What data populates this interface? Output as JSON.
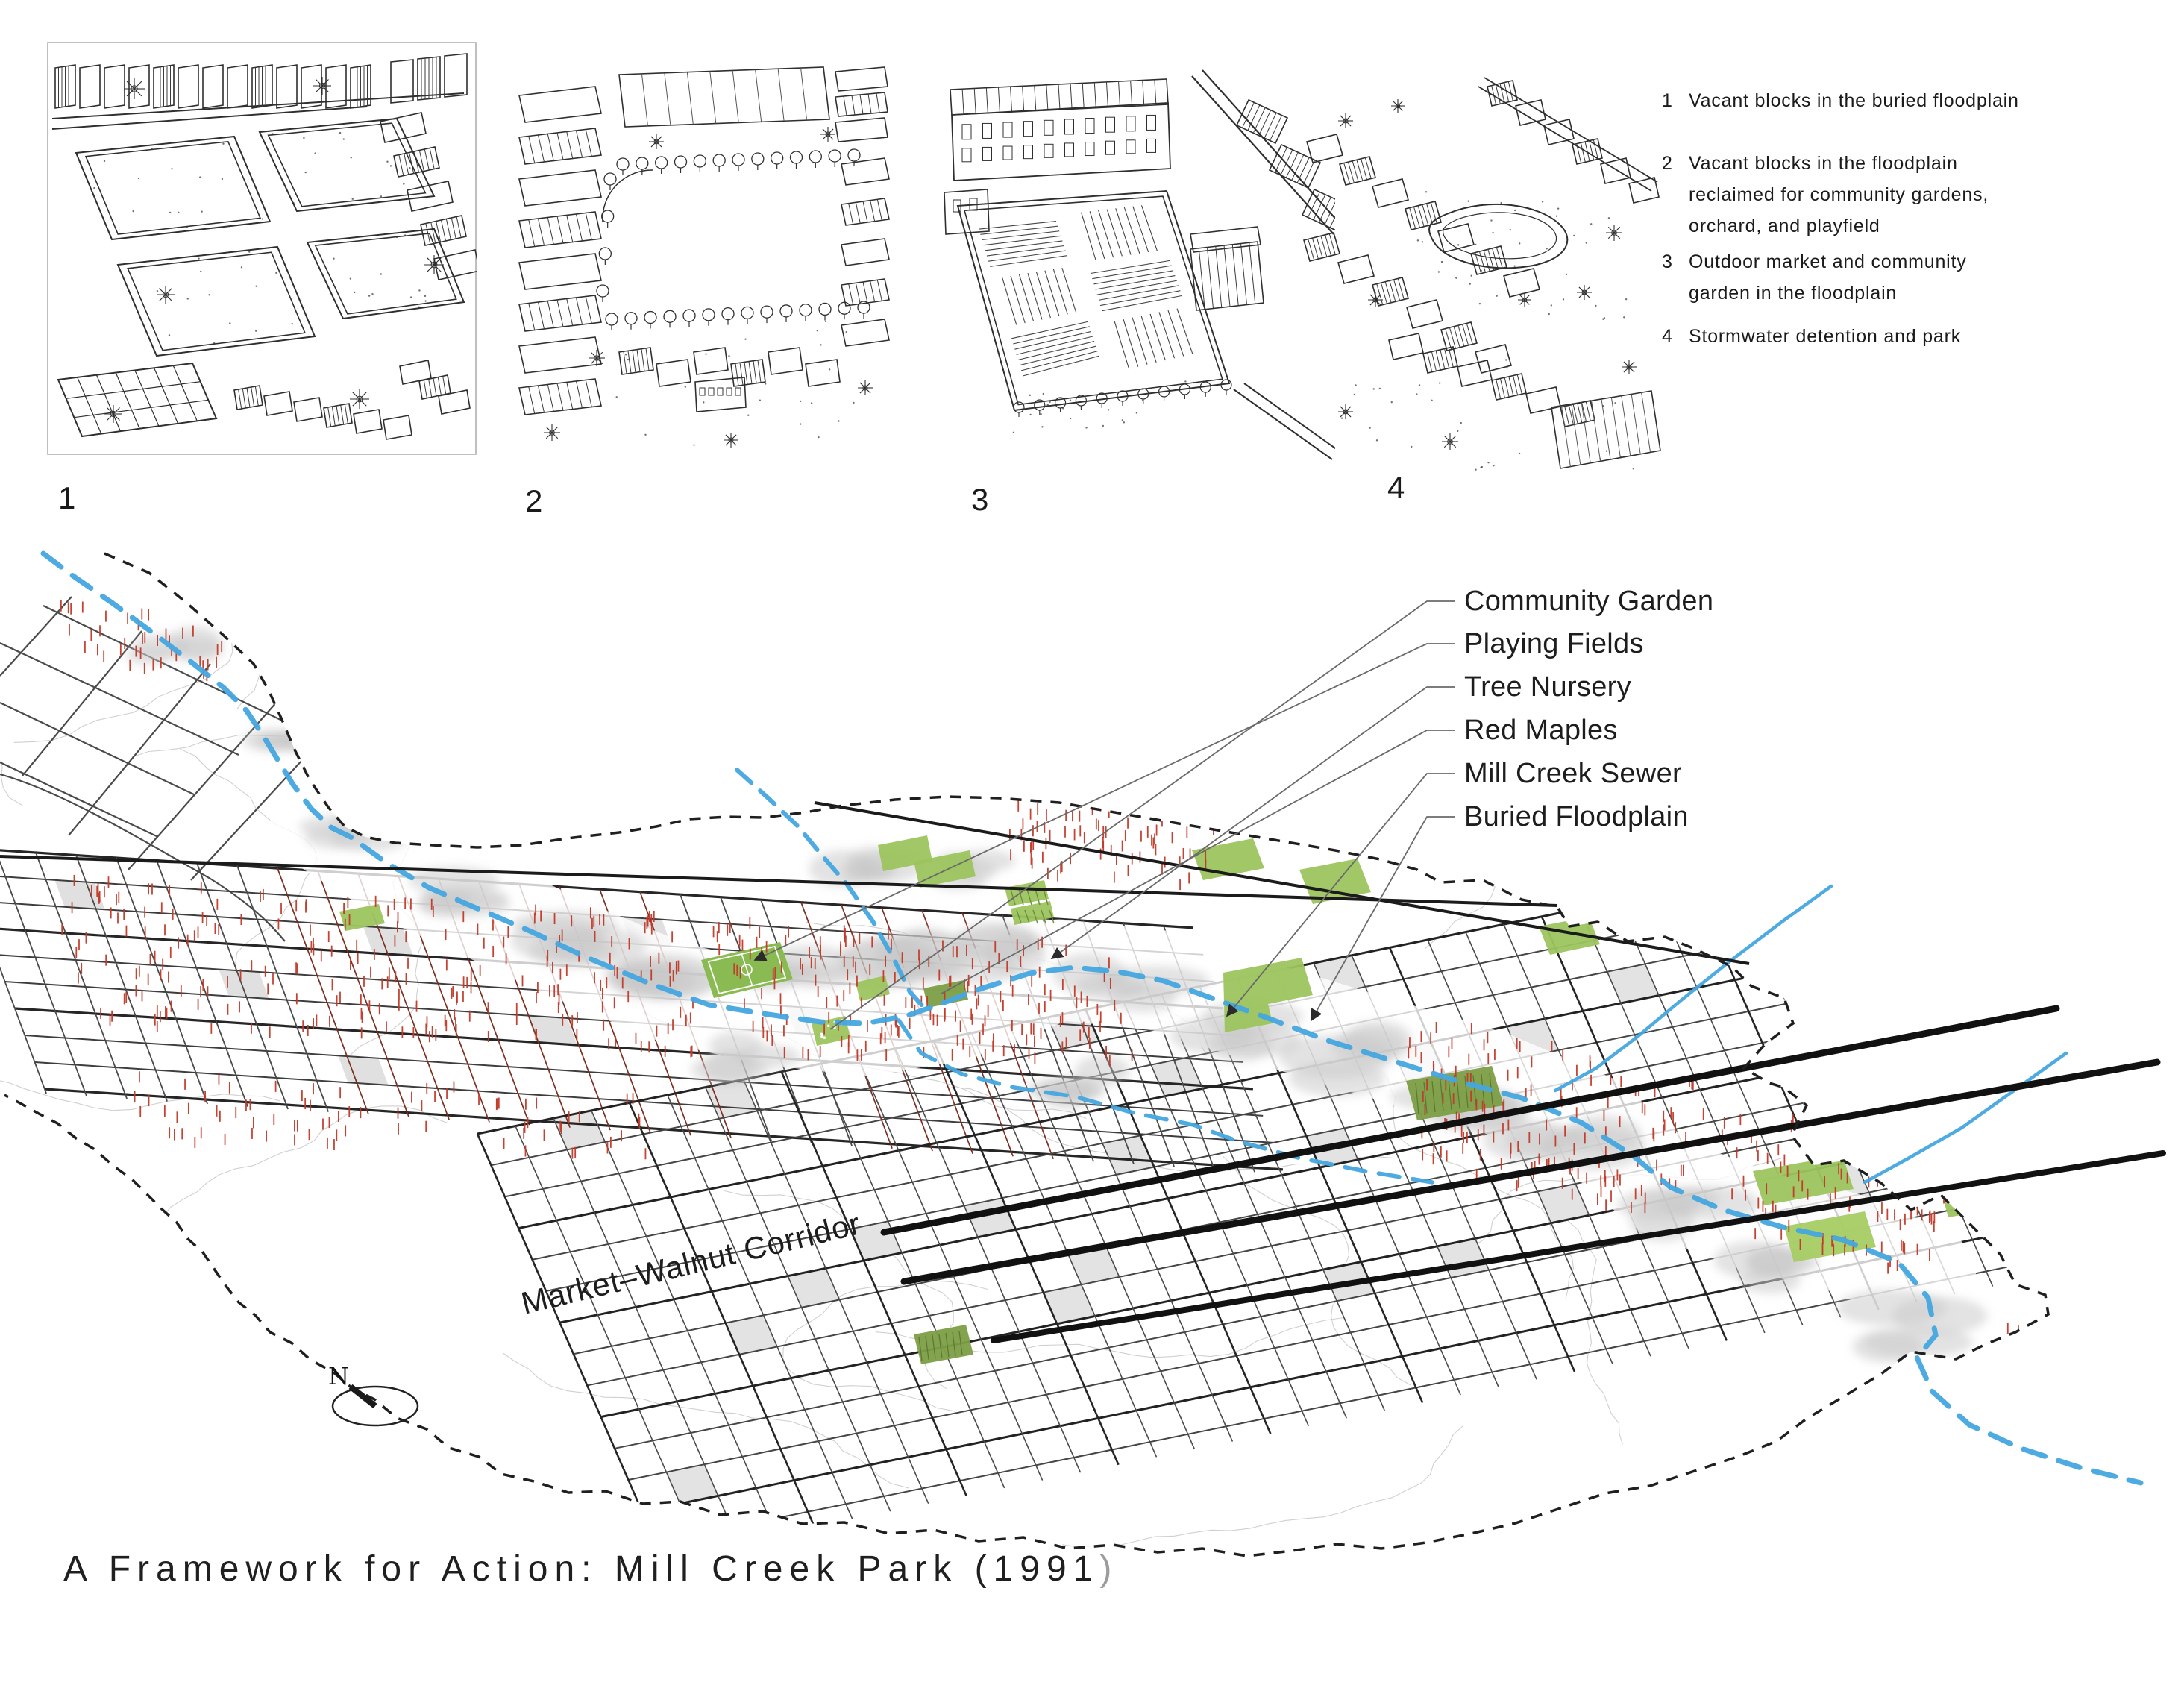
{
  "title": {
    "main": "A Framework for Action: Mill Creek Park (1991",
    "paren": ")"
  },
  "sketch_numbers": [
    "1",
    "2",
    "3",
    "4"
  ],
  "legend": {
    "items": [
      {
        "num": "1",
        "lines": [
          "Vacant blocks in the buried floodplain"
        ]
      },
      {
        "num": "2",
        "lines": [
          "Vacant blocks in the floodplain",
          "reclaimed for community gardens,",
          "orchard, and playfield"
        ]
      },
      {
        "num": "3",
        "lines": [
          "Outdoor market and community",
          "garden in the floodplain"
        ]
      },
      {
        "num": "4",
        "lines": [
          "Stormwater detention and park"
        ]
      }
    ]
  },
  "map": {
    "labels": [
      {
        "text": "Community Garden"
      },
      {
        "text": "Playing Fields"
      },
      {
        "text": "Tree Nursery"
      },
      {
        "text": "Red Maples"
      },
      {
        "text": "Mill Creek Sewer"
      },
      {
        "text": "Buried Floodplain"
      }
    ],
    "corridor_label": "Market–Walnut Corridor",
    "compass": "N",
    "colors": {
      "creek": "#45a7e0",
      "green": "#9cc45e",
      "green_dark": "#7d9e46",
      "field_green": "#8abb52",
      "red_tick": "#c13a2a",
      "parcel_red": "#7b2f21",
      "boundary": "#1f1f1f",
      "corridor": "#111111",
      "street": "#434343",
      "contour": "#c4c4c4"
    }
  }
}
